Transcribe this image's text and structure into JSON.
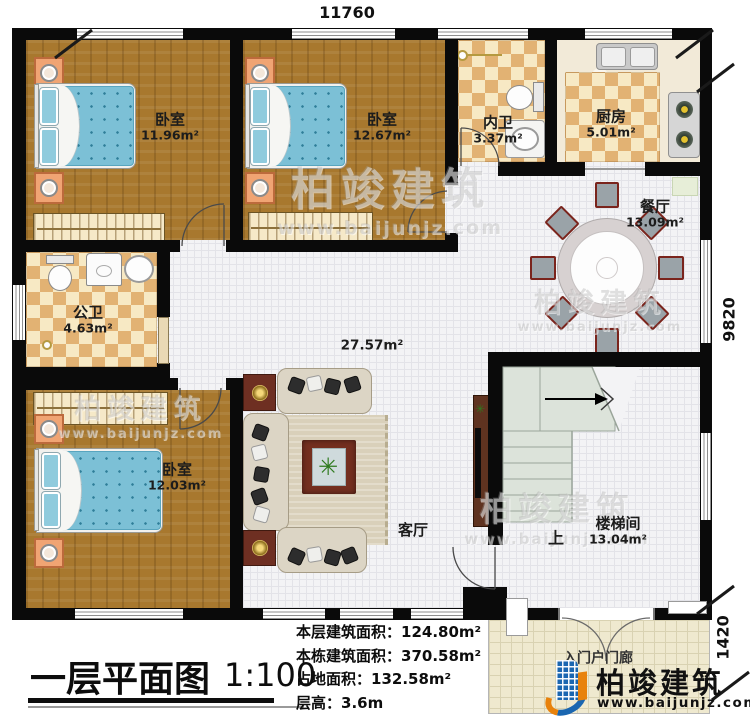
{
  "dimensions": {
    "top": "11760",
    "right_main": "9820",
    "right_porch": "1420"
  },
  "rooms": {
    "bedroom1": {
      "name": "卧室",
      "area": "11.96m²"
    },
    "bedroom2": {
      "name": "卧室",
      "area": "12.67m²"
    },
    "inner_bath": {
      "name": "内卫",
      "area": "3.37m²"
    },
    "kitchen": {
      "name": "厨房",
      "area": "5.01m²"
    },
    "dining": {
      "name": "餐厅",
      "area": "13.09m²"
    },
    "public_bath": {
      "name": "公卫",
      "area": "4.63m²"
    },
    "bedroom3": {
      "name": "卧室",
      "area": "12.03m²"
    },
    "living": {
      "name": "客厅",
      "area": "27.57m²"
    },
    "stairwell": {
      "name": "楼梯间",
      "area": "13.04m²",
      "direction": "上"
    },
    "porch": {
      "name": "入门户门廊"
    }
  },
  "footer": {
    "plan_title": "一层平面图",
    "scale": "1:100",
    "stats": [
      {
        "label": "本层建筑面积：",
        "value": "124.80m²"
      },
      {
        "label": "本栋建筑面积：",
        "value": "370.58m²"
      },
      {
        "label": "占地面积：",
        "value": "132.58m²"
      },
      {
        "label": "层高：",
        "value": "3.6m"
      }
    ]
  },
  "brand": {
    "name": "柏竣建筑",
    "website": "www.baijunjz.com"
  },
  "colors": {
    "wall": "#0a0a0a",
    "wood": "#a8782e",
    "tile_checker": "#e2b273",
    "brand_blue": "#1a66b0",
    "brand_orange": "#e8820c"
  }
}
